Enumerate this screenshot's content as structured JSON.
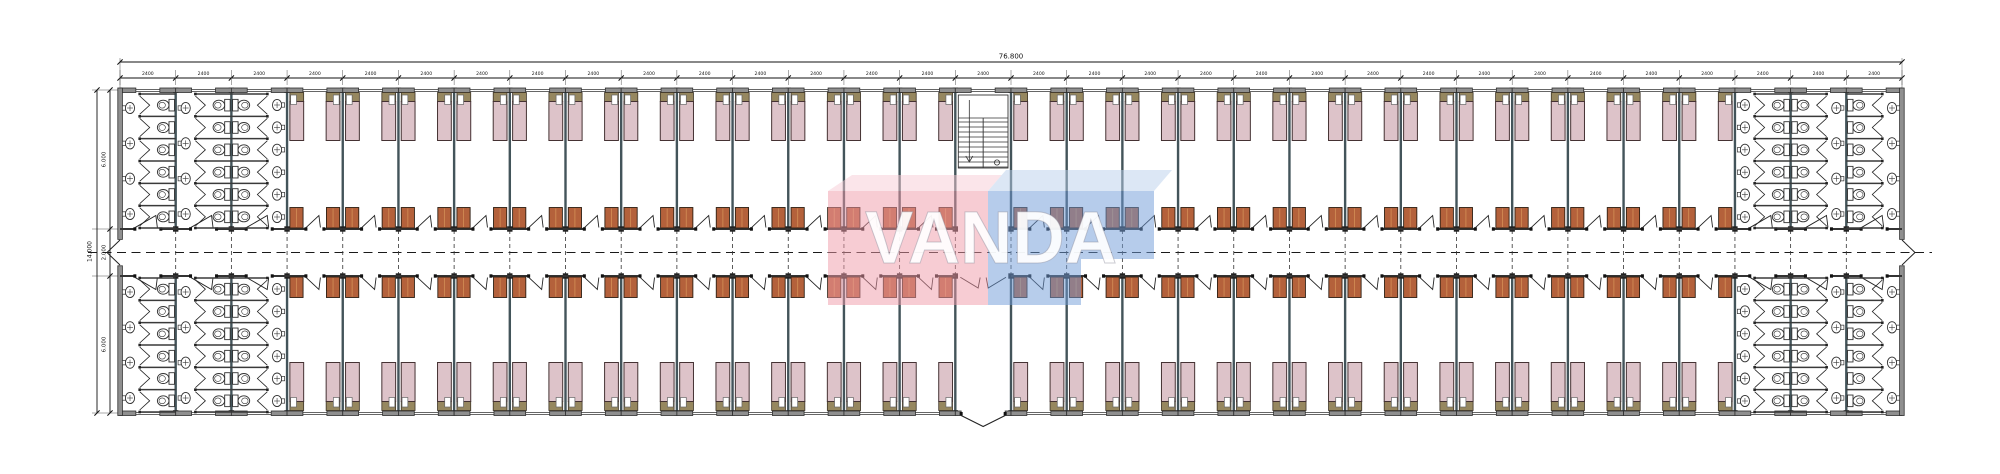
{
  "document": {
    "type": "architectural floor plan",
    "description": "Dormitory building plan: central corridor, bedroom wings, washroom blocks at both ends, central stairwell with entrance"
  },
  "watermark": {
    "text": "VANDA",
    "pink": "#F09AA8",
    "pink_light": "#F8CDD6",
    "blue": "#6F9BD8",
    "blue_light": "#BAD1EC",
    "text_color": "rgba(255,255,255,0.92)"
  },
  "dimensions": {
    "overall_width": "76.800",
    "bay_width": "2400",
    "bay_count": 32,
    "overall_height": "14.000",
    "top_wing_depth": "6.000",
    "corridor_width": "2.000",
    "bottom_wing_depth": "6.000"
  },
  "building": {
    "rooms": 50,
    "beds_per_room": 2,
    "lockers_per_room": 2,
    "total_beds": 100,
    "stairwells": 1,
    "washroom_blocks": 4,
    "toilet_stalls_per_block": 18,
    "sinks_per_block": 14,
    "corridor_exit_doors": 2,
    "main_entrance_doors": 1
  },
  "colors": {
    "bed": "#DDC3C9",
    "bed_headboard": "#96875F",
    "pillow": "#FFFFFF",
    "locker": "#B4613B",
    "locker_edge": "#2E2014",
    "wall_fill": "#8F8F8F",
    "wall_edge": "#2F2F2F",
    "partition": "#43545A",
    "line": "#333333",
    "dim": "#111111"
  }
}
